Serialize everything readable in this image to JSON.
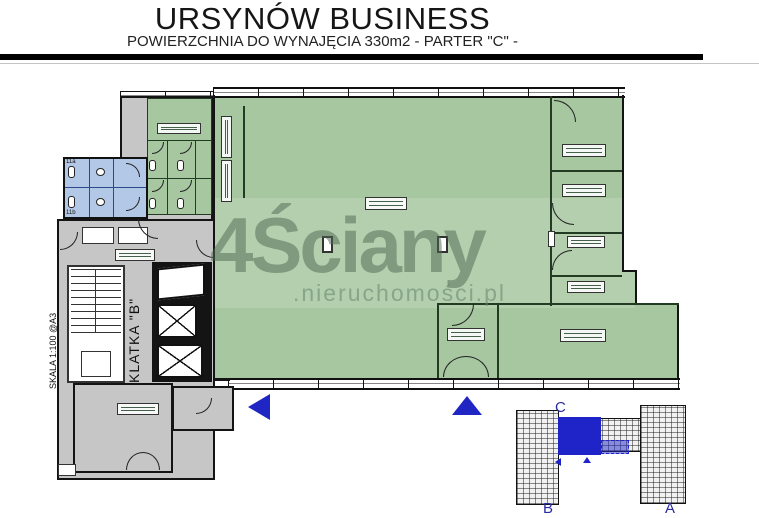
{
  "header": {
    "title": "URSYNÓW BUSINESS",
    "subtitle": "POWIERZCHNIA DO WYNAJĘCIA 330m2 - PARTER \"C\" -"
  },
  "plan": {
    "scale_note": "SKALA 1:100 @A3",
    "stairwell_label": "KLATKA \"B\"",
    "toilets": {
      "a": "11a",
      "b": "11b"
    }
  },
  "watermark": {
    "brand": "4Ściany",
    "domain": ".nieruchomości.pl"
  },
  "minimap": {
    "sections": {
      "c": "C",
      "b": "B",
      "a": "A"
    }
  },
  "colors": {
    "available": "#a6c7a0",
    "available-wall": "#233b23",
    "common": "#c6c6c6",
    "sanitary": "#b3c8e6",
    "wall": "#141414",
    "accent-blue": "#2026c4",
    "minimap-blue": "#1f24c8",
    "label-navy": "#2b2ba0"
  }
}
